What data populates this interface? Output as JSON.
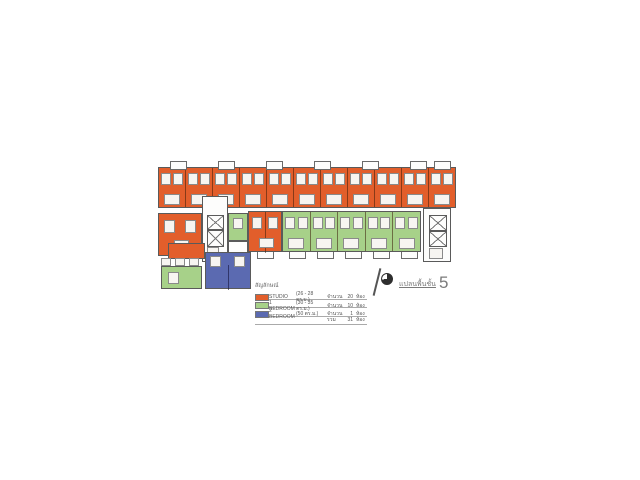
{
  "colors": {
    "studio": "#e25e2b",
    "one_bedroom": "#a7d189",
    "two_bedroom": "#5b6ab1",
    "wall": "#5a5a5a"
  },
  "plan": {
    "bands": [
      {
        "id": "top-band",
        "unit_type": "studio",
        "modules": 11
      },
      {
        "id": "green-band",
        "unit_type": "one_bedroom",
        "modules": 5
      }
    ],
    "top_balcony_x": [
      170,
      218,
      266,
      314,
      362,
      410,
      434
    ],
    "top_balcony_y": 161,
    "green_balcony_x": [
      289,
      317,
      345,
      373,
      401
    ],
    "green_balcony_y": 250,
    "orange_pair_balcony_x": [
      257
    ],
    "orange_pair_balcony_y": 250
  },
  "legend": {
    "title": "สัญลักษณ์",
    "rows": [
      {
        "type": "STUDIO",
        "size": "(26 - 28 ตร.ม.)",
        "qty_label": "จำนวน",
        "qty": "20",
        "unit": "ห้อง",
        "color_key": "studio"
      },
      {
        "type": "1 BEDROOM",
        "size": "(30 - 35 ตร.ม.)",
        "qty_label": "จำนวน",
        "qty": "10",
        "unit": "ห้อง",
        "color_key": "one_bedroom"
      },
      {
        "type": "2 BEDROOM",
        "size": "(50 ตร.ม.)",
        "qty_label": "จำนวน",
        "qty": "1",
        "unit": "ห้อง",
        "color_key": "two_bedroom"
      }
    ],
    "total": {
      "label": "รวม",
      "qty": "31",
      "unit": "ห้อง"
    }
  },
  "sheet_title": {
    "label": "แปลนพื้นชั้น",
    "floor_number": "5"
  }
}
